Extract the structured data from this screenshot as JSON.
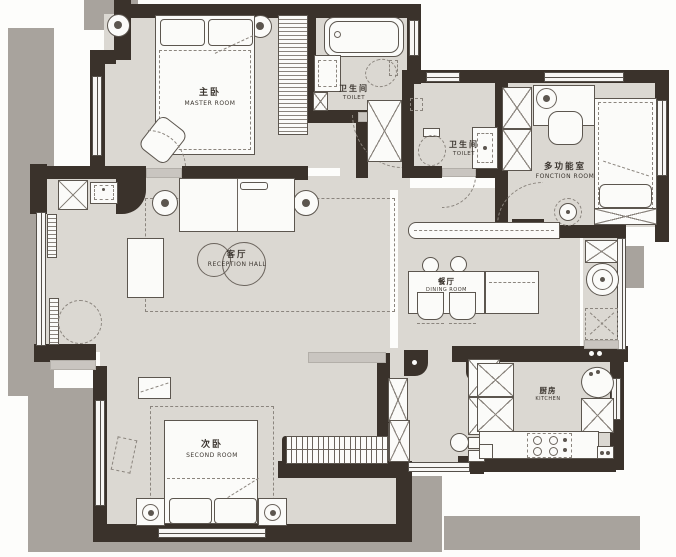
{
  "title": "apartment-floor-plan",
  "colors": {
    "wall": "#3a322b",
    "floor": "#dbd8d2",
    "shadow": "#a8a39d",
    "background": "#fdfdfb",
    "furniture": "#fbfbf9",
    "outline": "#5c564f"
  },
  "rooms": {
    "master": {
      "zh": "主卧",
      "en": "MASTER ROOM"
    },
    "toilet_top": {
      "zh": "卫生间",
      "en": "TOILET"
    },
    "toilet_mid": {
      "zh": "卫生间",
      "en": "TOILET"
    },
    "fonction": {
      "zh": "多功能室",
      "en": "FONCTION ROOM"
    },
    "reception": {
      "zh": "客厅",
      "en": "RECEPTION HALL"
    },
    "dining": {
      "zh": "餐厅",
      "en": "DINING ROOM"
    },
    "second": {
      "zh": "次卧",
      "en": "SECOND ROOM"
    },
    "kitchen": {
      "zh": "厨房",
      "en": "KITCHEN"
    }
  }
}
